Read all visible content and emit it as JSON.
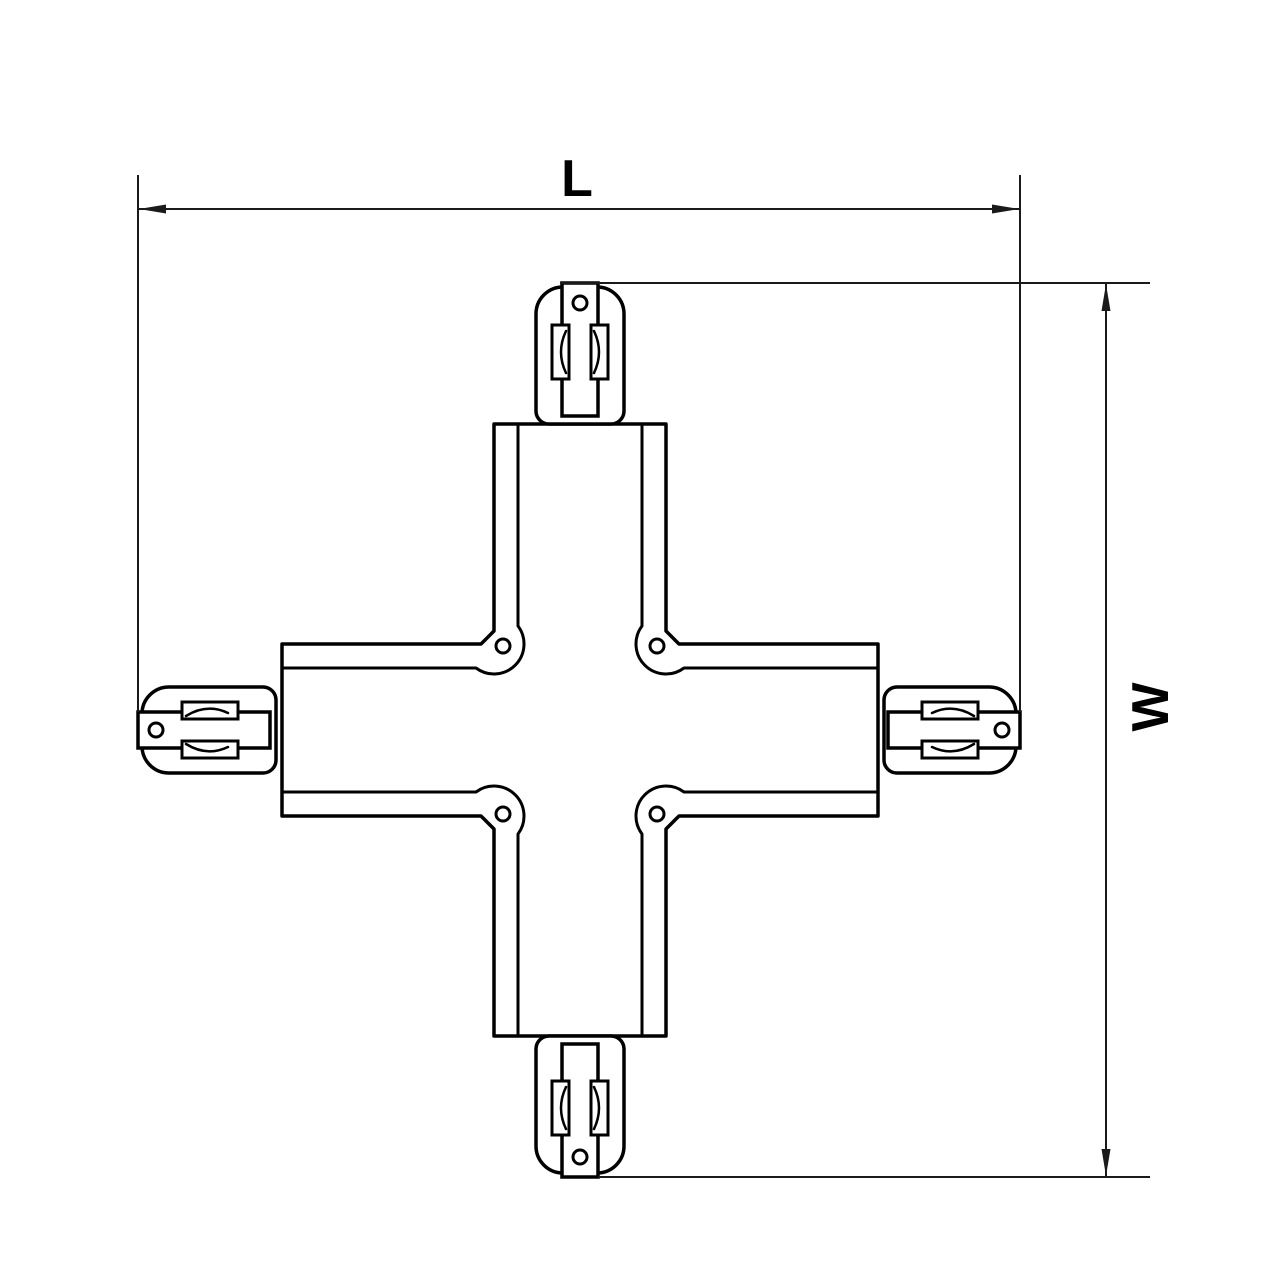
{
  "page": {
    "background_color": "#ffffff",
    "line_color": "#000000",
    "dimension_color": "#1a1a1a"
  },
  "drawing": {
    "kind": "technical line drawing",
    "subject": "four-way X-shaped track connector, plan view",
    "dimensions": {
      "length": {
        "label": "L",
        "orientation": "horizontal"
      },
      "width": {
        "label": "W",
        "orientation": "vertical"
      }
    },
    "features": {
      "connector_count": 4,
      "corner_screw_count": 4,
      "contact_clips_per_connector": 2
    }
  }
}
